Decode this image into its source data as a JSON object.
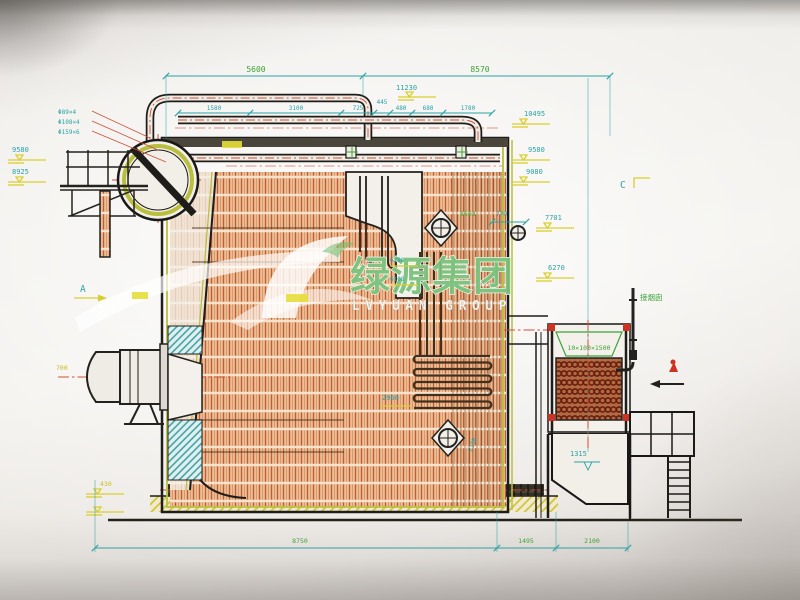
{
  "watermark": {
    "cn": "绿源集团",
    "en": "LVYUAN GROUP"
  },
  "dims": {
    "top_left": "5600",
    "top_right": "8570",
    "chain": [
      "1580",
      "3100",
      "725",
      "445",
      "480",
      "680",
      "1780"
    ],
    "bottom": [
      "8750",
      "1495",
      "2100"
    ],
    "elev_right": {
      "e11230": "11230",
      "e10495": "10495",
      "e9580": "9580",
      "e9080": "9080",
      "e7701": "7701",
      "e6270": "6270"
    },
    "elev_left": {
      "e9580": "9580",
      "e8925": "8925"
    },
    "inner": {
      "i8603": "8603",
      "i770": "770",
      "i6280": "6280",
      "i6100": "6100",
      "i2960": "2960",
      "i2100": "2100",
      "i1315": "1315",
      "i430": "430",
      "i700": "700"
    },
    "pipe_specs": [
      "Φ89×4",
      "Φ108×4",
      "Φ159×6"
    ]
  },
  "markers": {
    "section_a": "A",
    "section_c": "C"
  },
  "notes": {
    "flue": "接烟囱",
    "eco_spec": "10×100×1500"
  },
  "colors": {
    "dimension_teal": "#2ba3a5",
    "dimension_green": "#3da433",
    "annotation_yellow": "#d9ce2e",
    "refractory_orange": "#c05c32",
    "centerline_red": "#cd4f35",
    "casing_olive": "#b9be3c",
    "watermark_green": "#6fbb6f"
  }
}
